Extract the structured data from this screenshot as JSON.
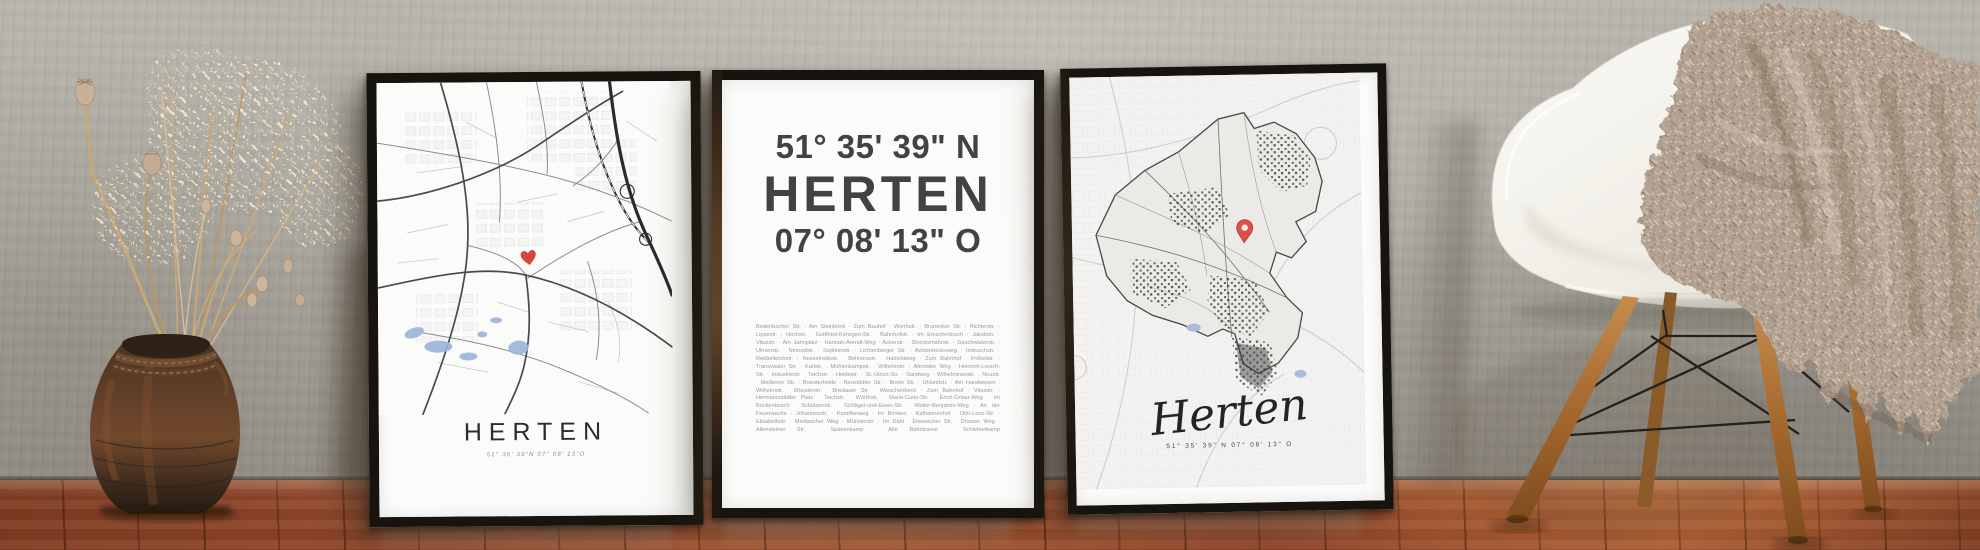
{
  "colors": {
    "accent_red": "#d6453f",
    "frame_black": "#17140f",
    "wall_gray": "#b0ada4",
    "floor_brown": "#8a4426",
    "chair_white": "#f3f1ea",
    "blanket_beige": "#b2a090",
    "water_blue": "#9ab4da"
  },
  "posters": {
    "left": {
      "title": "HERTEN",
      "coords": "51° 35' 39\"N 07° 08' 13\"O"
    },
    "middle": {
      "latitude": "51° 35' 39\" N",
      "title": "HERTEN",
      "longitude": "07° 08' 13\" O",
      "streets": "Bodenbacher Str. · Am Steinbrink · Zum Bauhof · Worthstr. · Brunecker Str. · Richterstr. · Lippestr. · Hochstr. · Gottfried-Könzgen-Str. · Bahnhofstr. · Im Emscherbruch · Jakobstr. · Vitusstr. · Am Jahnplatz · Hannah-Arendt-Weg · Ackerstr. · Storcksmährstr. · Geschwisterstr. · Ulmenstr. · Nimrodstr. · Sophienstr. · Lichtenberger Str. · Achtenbecksweg · Imbuschstr. · Rebbelteichstr. · Nesselrodestr. · Behrensstr. · Habichtweg · Zum Bahnhof · Fröbelstr. · Transvaaler Str. · Karlstr. · Mühlenkampstr. · Wilhelmstr. · Ahrntaler Weg · Heinrich-Lersch-Str. · Industriestr. · Teichstr. · Heidestr. · St.-Ulrich-Str. · Sandweg · Wilhelminenstr. · Neustr. · Meißener Str. · Branderheide · Neustädter Str. · Breite Str. · Uhlandstr. · Am Handweiser · Wilhelmstr. · Münsterstr. · Breslauer Str. · Wieschenbeck · Zum Bahnhof · Vitusstr. · Hermannstädter Platz · Teichstr. · Wörthstr. · Marie-Curie-Str. · Erich-Grisar-Weg · Im Bockenbusch · Schützenstr. · Schlägel-und-Eisen-Str. · Walter-Benjamin-Weg · An der Feuerwache · Johannesstr. · Kamillenweg · Im Brinken · Katharinenhof · Otto-Lenz-Str. · Elisabethstr. · Mediascher Weg · Münsterstr. · Im Dahl · Eisenacher Str. · Drusser Weg · Allensteiner Str. · Spanenkamp · Alte Bahntrasse · Schlehenkamp"
    },
    "right": {
      "title": "Herten",
      "coords": "51° 35' 39\" N 07° 08' 13\" O"
    }
  }
}
